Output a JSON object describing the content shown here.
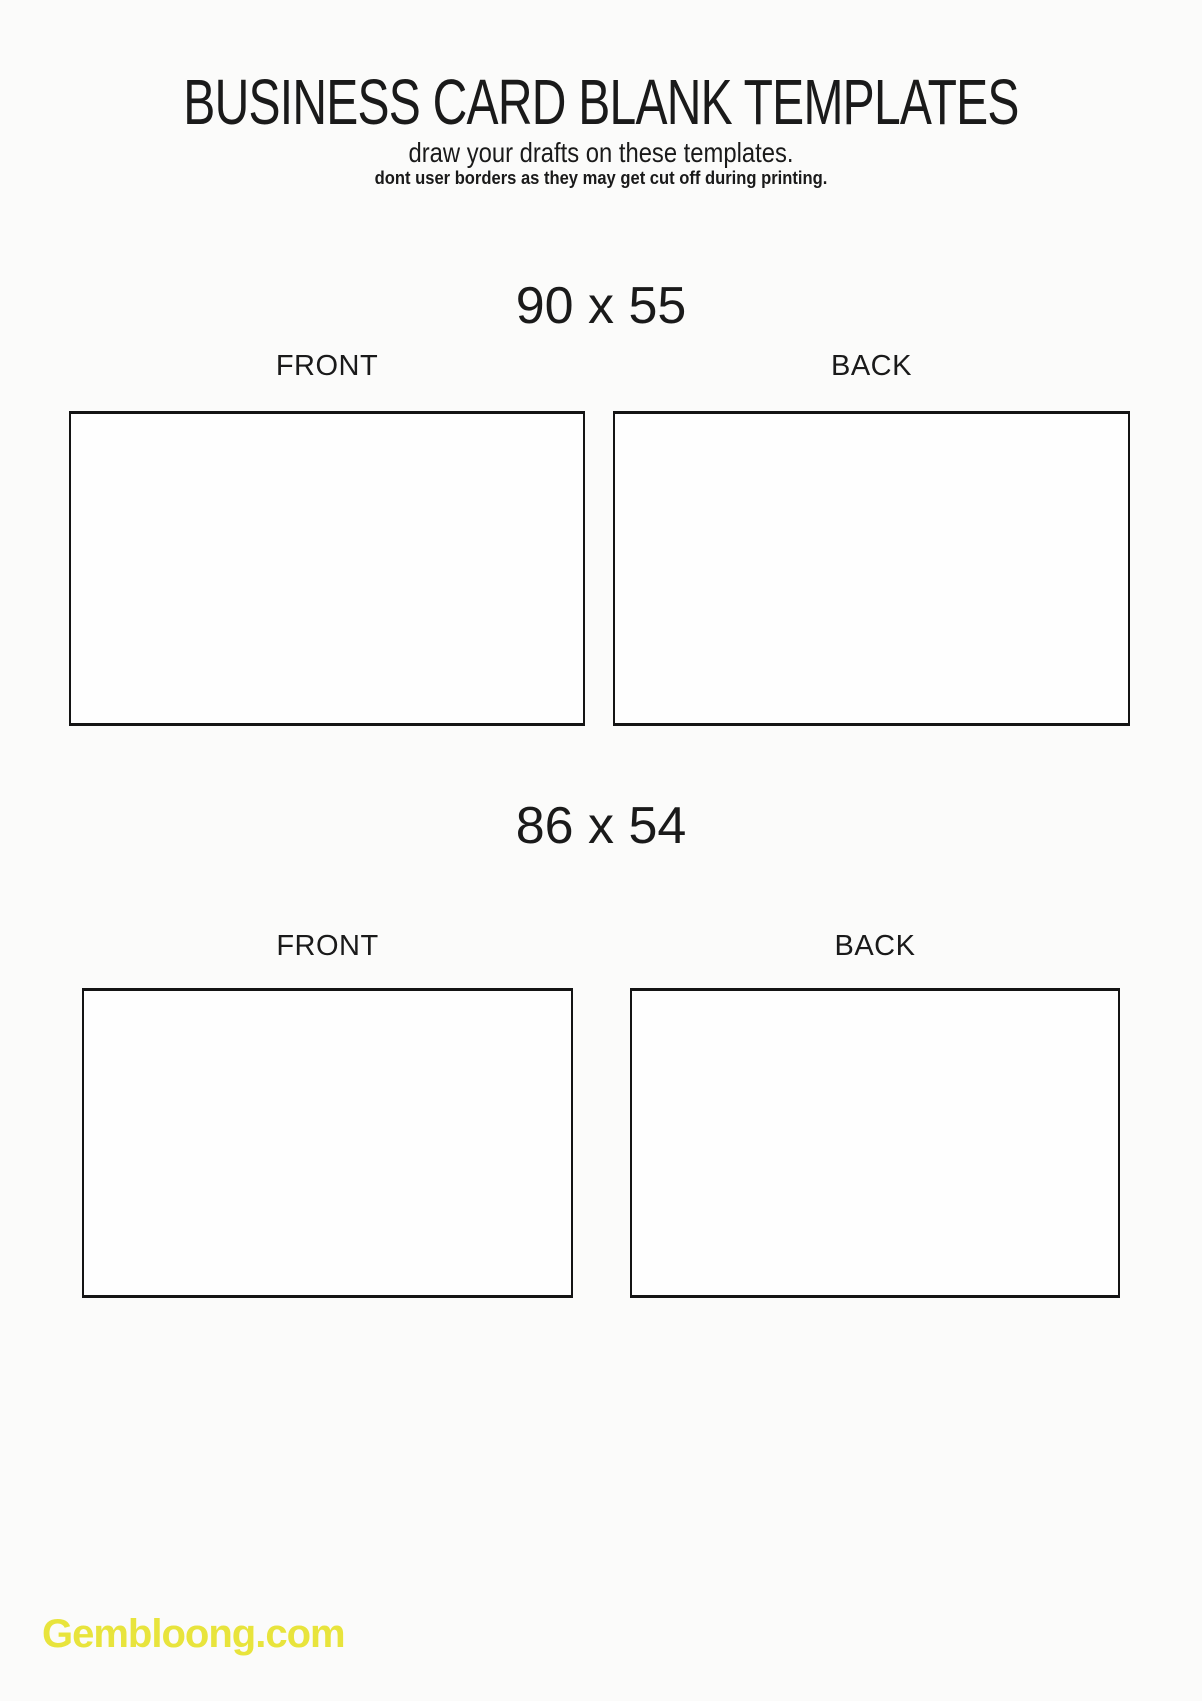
{
  "page": {
    "title": "BUSINESS CARD BLANK TEMPLATES",
    "subtitle": "draw your drafts on these templates.",
    "note": "dont user borders as they may get cut off during printing."
  },
  "sections": [
    {
      "size_label": "90 x 55",
      "front_label": "FRONT",
      "back_label": "BACK"
    },
    {
      "size_label": "86 x 54",
      "front_label": "FRONT",
      "back_label": "BACK"
    }
  ],
  "watermark": {
    "text": "Gembloong.com",
    "color": "#e8e43c"
  },
  "colors": {
    "background": "#fbfbfa",
    "text": "#1a1a1a",
    "card_border": "#141414"
  }
}
